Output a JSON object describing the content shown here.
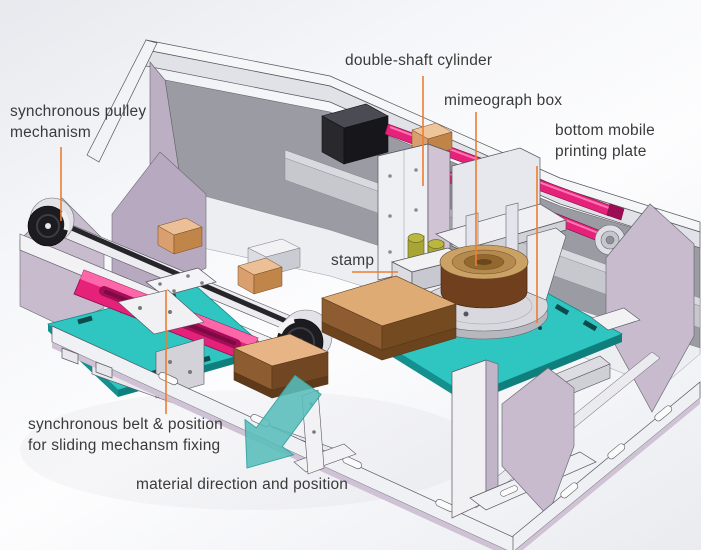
{
  "figure": {
    "subject": "annotated CAD model of automatic stamping machine"
  },
  "labels": {
    "synchronous_pulley_mechanism": "synchronous pulley\nmechanism",
    "double_shaft_cylinder": "double-shaft cylinder",
    "mimeograph_box": "mimeograph box",
    "bottom_mobile_printing_plate": "bottom mobile\nprinting plate",
    "stamp": "stamp",
    "synchronous_belt": "synchronous belt & position\nfor sliding mechansm fixing",
    "material_direction": "material direction and position"
  },
  "colors": {
    "leader_line": "#ed7d31",
    "arrow": "#58bdb9",
    "plate_teal": "#2fc5c1",
    "rail_pink": "#e62179",
    "panel_lavender": "#c8bbce",
    "frame_gray": "#9b9ba3",
    "stamp_brown": "#8d5c31",
    "label_text": "#3a3a3a"
  }
}
